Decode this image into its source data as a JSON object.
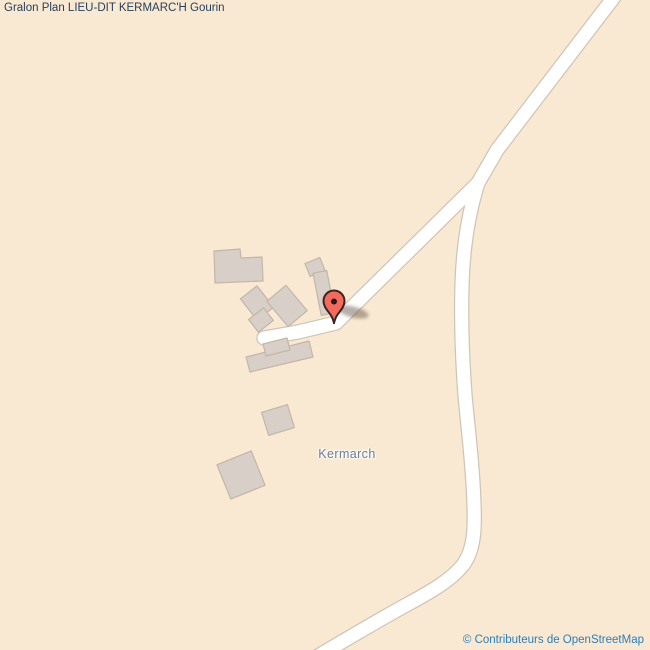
{
  "header": {
    "title": "Gralon Plan LIEU-DIT KERMARC'H Gourin"
  },
  "map": {
    "place_label": "Kermarch",
    "marker": {
      "name": "location-pin",
      "color": "#f26b5e",
      "outline_color": "#3b241e"
    },
    "colors": {
      "background": "#f9e9d2",
      "road_fill": "#ffffff",
      "road_casing": "#cfc5b6",
      "building_fill": "#d8cfc8",
      "building_outline": "#c2b6a7",
      "title_text": "#26405c",
      "place_label_text": "#6f7b90",
      "attribution_text": "#2e7eb8"
    }
  },
  "footer": {
    "attribution": "© Contributeurs de OpenStreetMap"
  }
}
